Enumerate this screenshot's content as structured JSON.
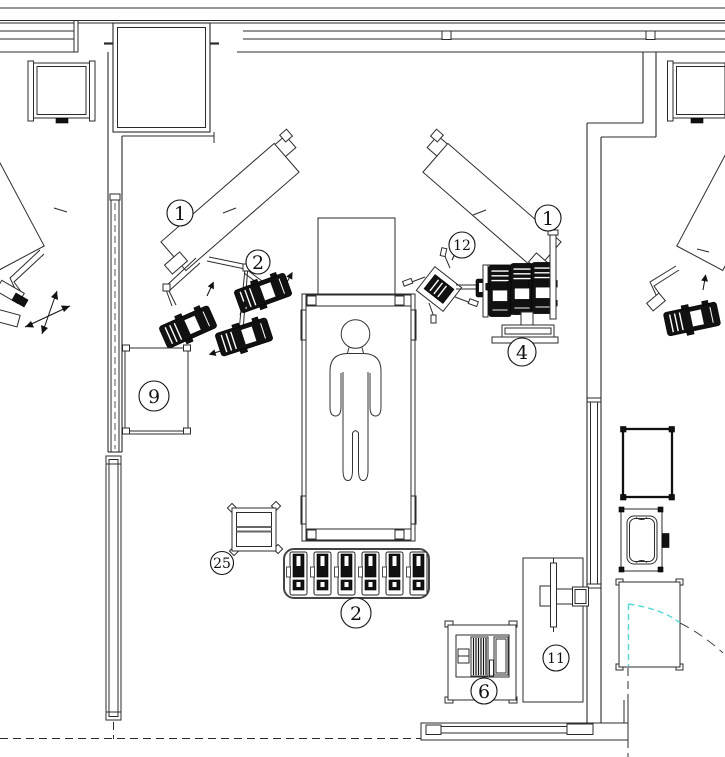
{
  "figure": {
    "type": "floor-plan",
    "description": "CAD floor plan of a robotic operating room with adjacent rooms"
  },
  "colors": {
    "line": "#2b2b2b",
    "dark_fill": "#111111",
    "door_swing_cyan": "#55d7d7",
    "outer_arc": "#444444",
    "background": "#ffffff"
  },
  "callouts": [
    {
      "label": "1",
      "item": "robotic-rail-left"
    },
    {
      "label": "2",
      "item": "manipulator-group-left"
    },
    {
      "label": "1",
      "item": "robotic-rail-right"
    },
    {
      "label": "12",
      "item": "mobile-stand"
    },
    {
      "label": "4",
      "item": "equipment-column"
    },
    {
      "label": "9",
      "item": "side-table"
    },
    {
      "label": "25",
      "item": "instrument-cart"
    },
    {
      "label": "2",
      "item": "manipulator-tray"
    },
    {
      "label": "6",
      "item": "equipment-cart"
    },
    {
      "label": "11",
      "item": "monitor-cart"
    }
  ]
}
